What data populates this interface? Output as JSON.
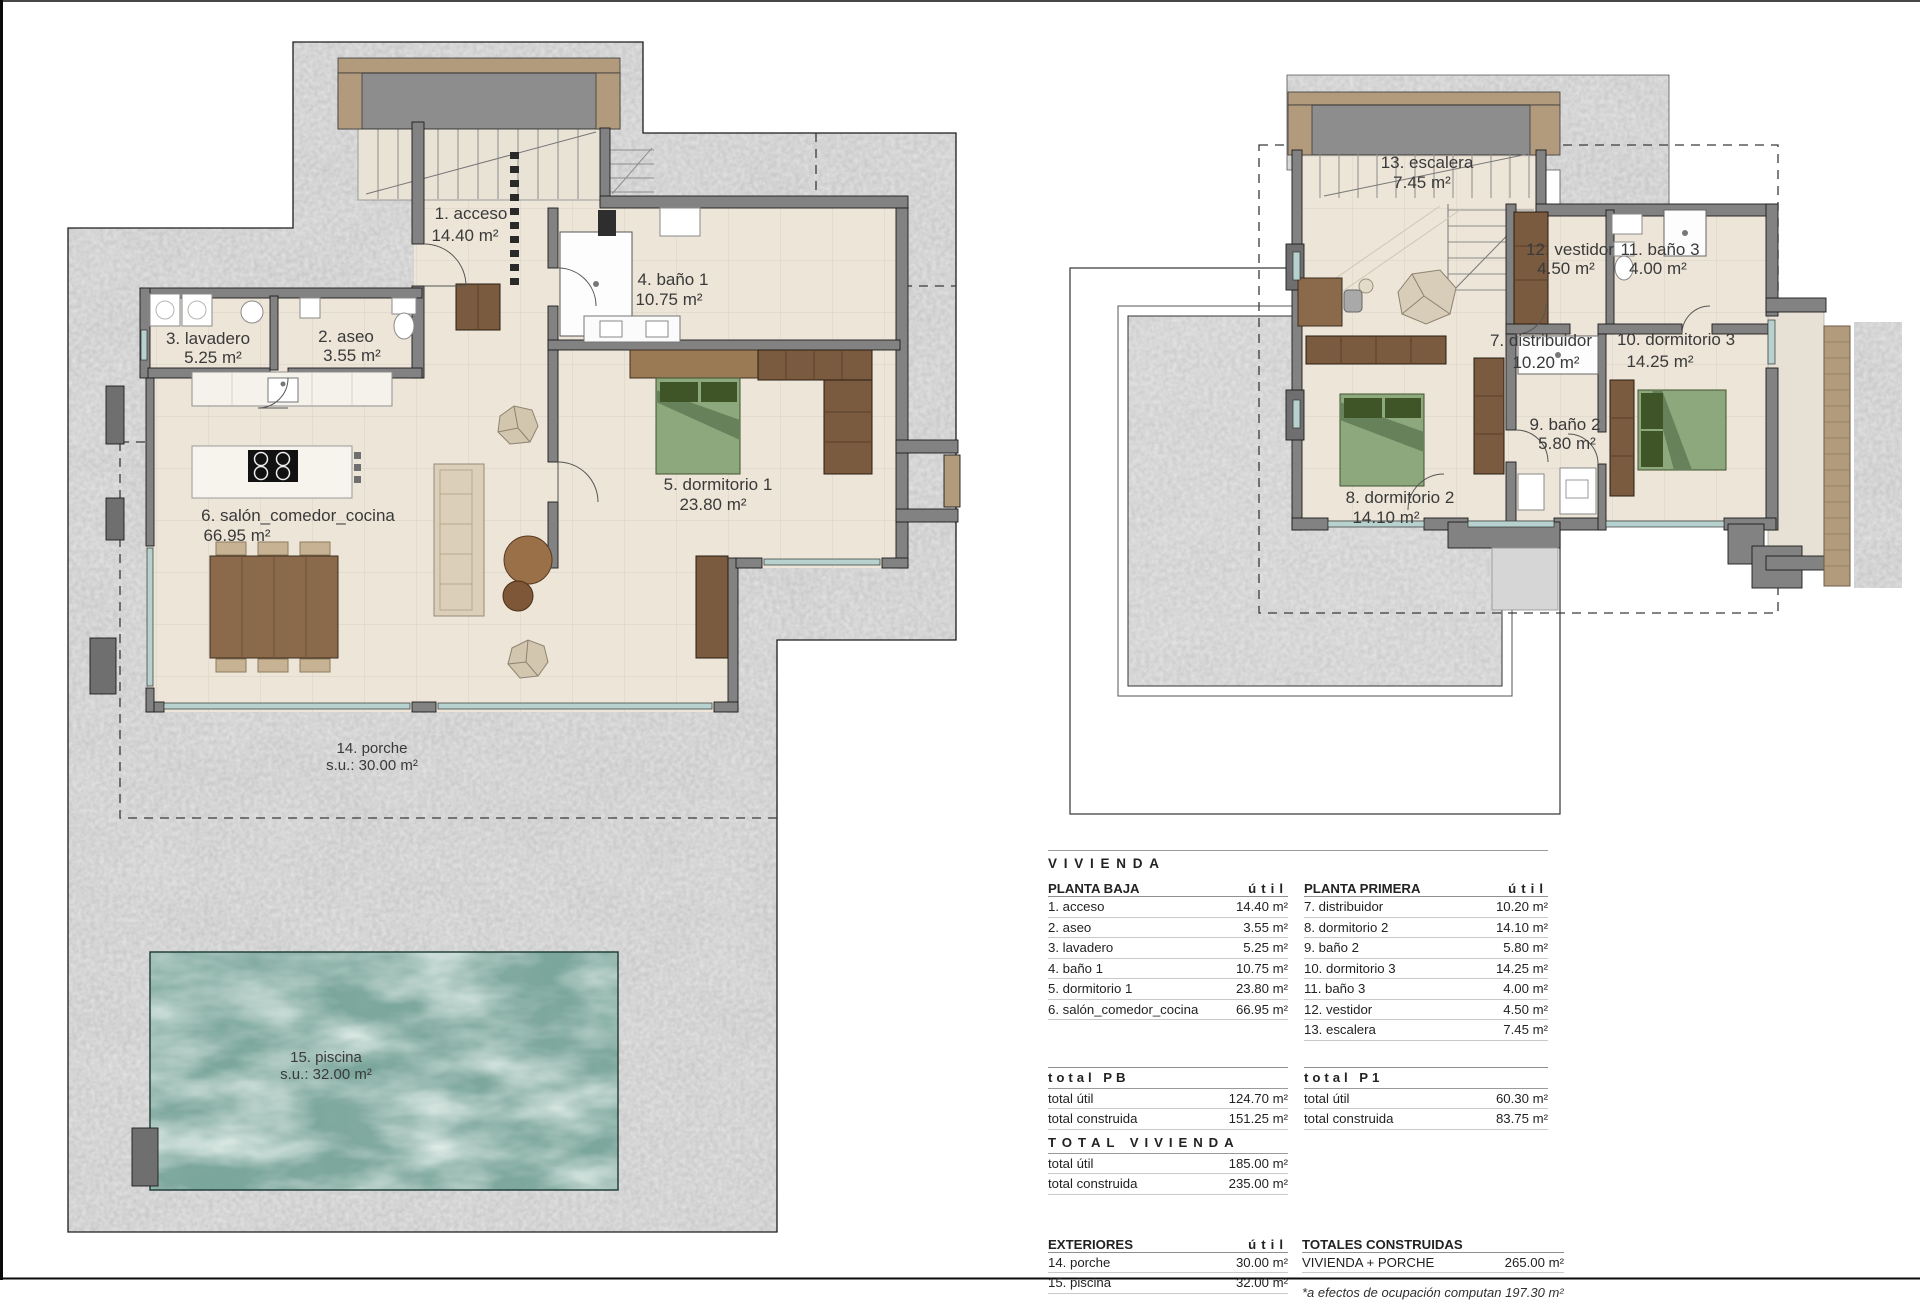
{
  "colors": {
    "plot_gray": "#c9c9c9",
    "floor_beige": "#ece5d8",
    "wall_gray": "#828282",
    "wood_brown": "#7b5b3f",
    "bed_green": "#8da87d",
    "pool_teal": "#7ba69b",
    "canopy_tan": "#b29b7d",
    "glass_blue": "#b7d2ce"
  },
  "plans": {
    "pb": {
      "name": "planta baja",
      "labels": [
        {
          "t": "1. acceso",
          "a": "14.40 m²"
        },
        {
          "t": "2. aseo",
          "a": "3.55 m²"
        },
        {
          "t": "3. lavadero",
          "a": "5.25 m²"
        },
        {
          "t": "4. baño 1",
          "a": "10.75 m²"
        },
        {
          "t": "5. dormitorio 1",
          "a": "23.80 m²"
        },
        {
          "t": "6. salón_comedor_cocina",
          "a": "66.95 m²"
        },
        {
          "t": "14. porche",
          "a": "s.u.: 30.00 m²"
        },
        {
          "t": "15. piscina",
          "a": "s.u.: 32.00 m²"
        }
      ]
    },
    "pp": {
      "name": "planta primera",
      "labels": [
        {
          "t": "13. escalera",
          "a": "7.45 m²"
        },
        {
          "t": "7. distribuidor",
          "a": "10.20 m²"
        },
        {
          "t": "12. vestidor",
          "a": "4.50 m²"
        },
        {
          "t": "11. baño 3",
          "a": "4.00 m²"
        },
        {
          "t": "10. dormitorio 3",
          "a": "14.25 m²"
        },
        {
          "t": "9. baño 2",
          "a": "5.80 m²"
        },
        {
          "t": "8. dormitorio 2",
          "a": "14.10 m²"
        }
      ]
    }
  },
  "summary": {
    "title": "VIVIENDA",
    "planta_baja": {
      "header": "PLANTA BAJA",
      "util_header": "útil",
      "rows": [
        {
          "name": "1. acceso",
          "value": "14.40 m²"
        },
        {
          "name": "2. aseo",
          "value": "3.55 m²"
        },
        {
          "name": "3. lavadero",
          "value": "5.25 m²"
        },
        {
          "name": "4. baño 1",
          "value": "10.75 m²"
        },
        {
          "name": "5. dormitorio 1",
          "value": "23.80 m²"
        },
        {
          "name": "6. salón_comedor_cocina",
          "value": "66.95 m²"
        }
      ]
    },
    "planta_primera": {
      "header": "PLANTA PRIMERA",
      "util_header": "útil",
      "rows": [
        {
          "name": "7. distribuidor",
          "value": "10.20 m²"
        },
        {
          "name": "8. dormitorio 2",
          "value": "14.10 m²"
        },
        {
          "name": "9. baño 2",
          "value": "5.80 m²"
        },
        {
          "name": "10. dormitorio 3",
          "value": "14.25 m²"
        },
        {
          "name": "11. baño 3",
          "value": "4.00 m²"
        },
        {
          "name": "12. vestidor",
          "value": "4.50 m²"
        },
        {
          "name": "13. escalera",
          "value": "7.45 m²"
        }
      ]
    },
    "total_pb": {
      "title": "total PB",
      "rows": [
        {
          "name": "total útil",
          "value": "124.70 m²"
        },
        {
          "name": "total construida",
          "value": "151.25 m²"
        }
      ]
    },
    "total_p1": {
      "title": "total P1",
      "rows": [
        {
          "name": "total útil",
          "value": "60.30 m²"
        },
        {
          "name": "total construida",
          "value": "83.75 m²"
        }
      ]
    },
    "total_vivienda": {
      "title": "TOTAL VIVIENDA",
      "rows": [
        {
          "name": "total útil",
          "value": "185.00 m²"
        },
        {
          "name": "total construida",
          "value": "235.00 m²"
        }
      ]
    },
    "exteriores": {
      "title": "EXTERIORES",
      "util_header": "útil",
      "rows": [
        {
          "name": "14. porche",
          "value": "30.00 m²"
        },
        {
          "name": "15. piscina",
          "value": "32.00 m²"
        }
      ]
    },
    "totales_construidas": {
      "title": "TOTALES CONSTRUIDAS",
      "rows": [
        {
          "name": "VIVIENDA + PORCHE",
          "value": "265.00 m²"
        }
      ],
      "footnote": "*a efectos de ocupación computan 197.30 m²"
    }
  }
}
